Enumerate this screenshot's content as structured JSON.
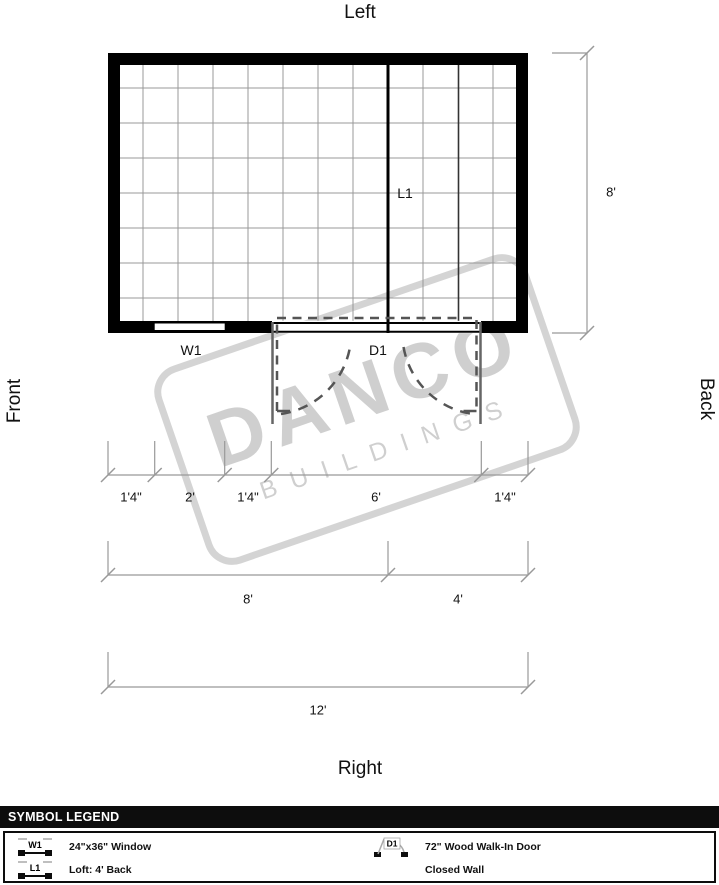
{
  "orientation": {
    "top": "Left",
    "right": "Back",
    "bottom": "Right",
    "left": "Front"
  },
  "plan_labels": {
    "window": "W1",
    "loft": "L1",
    "door": "D1"
  },
  "dimensions": {
    "side_height": "8'",
    "front_segments": [
      "1'4\"",
      "2'",
      "1'4\"",
      "6'",
      "1'4\""
    ],
    "split_segments": [
      "8'",
      "4'"
    ],
    "total": "12'"
  },
  "watermark": {
    "name": "DANCO",
    "sub": "BUILDINGS"
  },
  "legend": {
    "title": "SYMBOL LEGEND",
    "items": [
      {
        "code": "W1",
        "label": "24\"x36\" Window"
      },
      {
        "code": "D1",
        "label": "72\" Wood Walk-In Door"
      },
      {
        "code": "L1",
        "label": "Loft: 4' Back"
      },
      {
        "code": "",
        "label": "Closed Wall"
      }
    ]
  },
  "colors": {
    "wall": "#000000",
    "grid": "#999999",
    "dimension_line": "#999999",
    "door_dash": "#555555",
    "watermark": "#c8c8c8",
    "legend_header_bg": "#0d0d0d",
    "legend_header_text": "#ffffff"
  }
}
